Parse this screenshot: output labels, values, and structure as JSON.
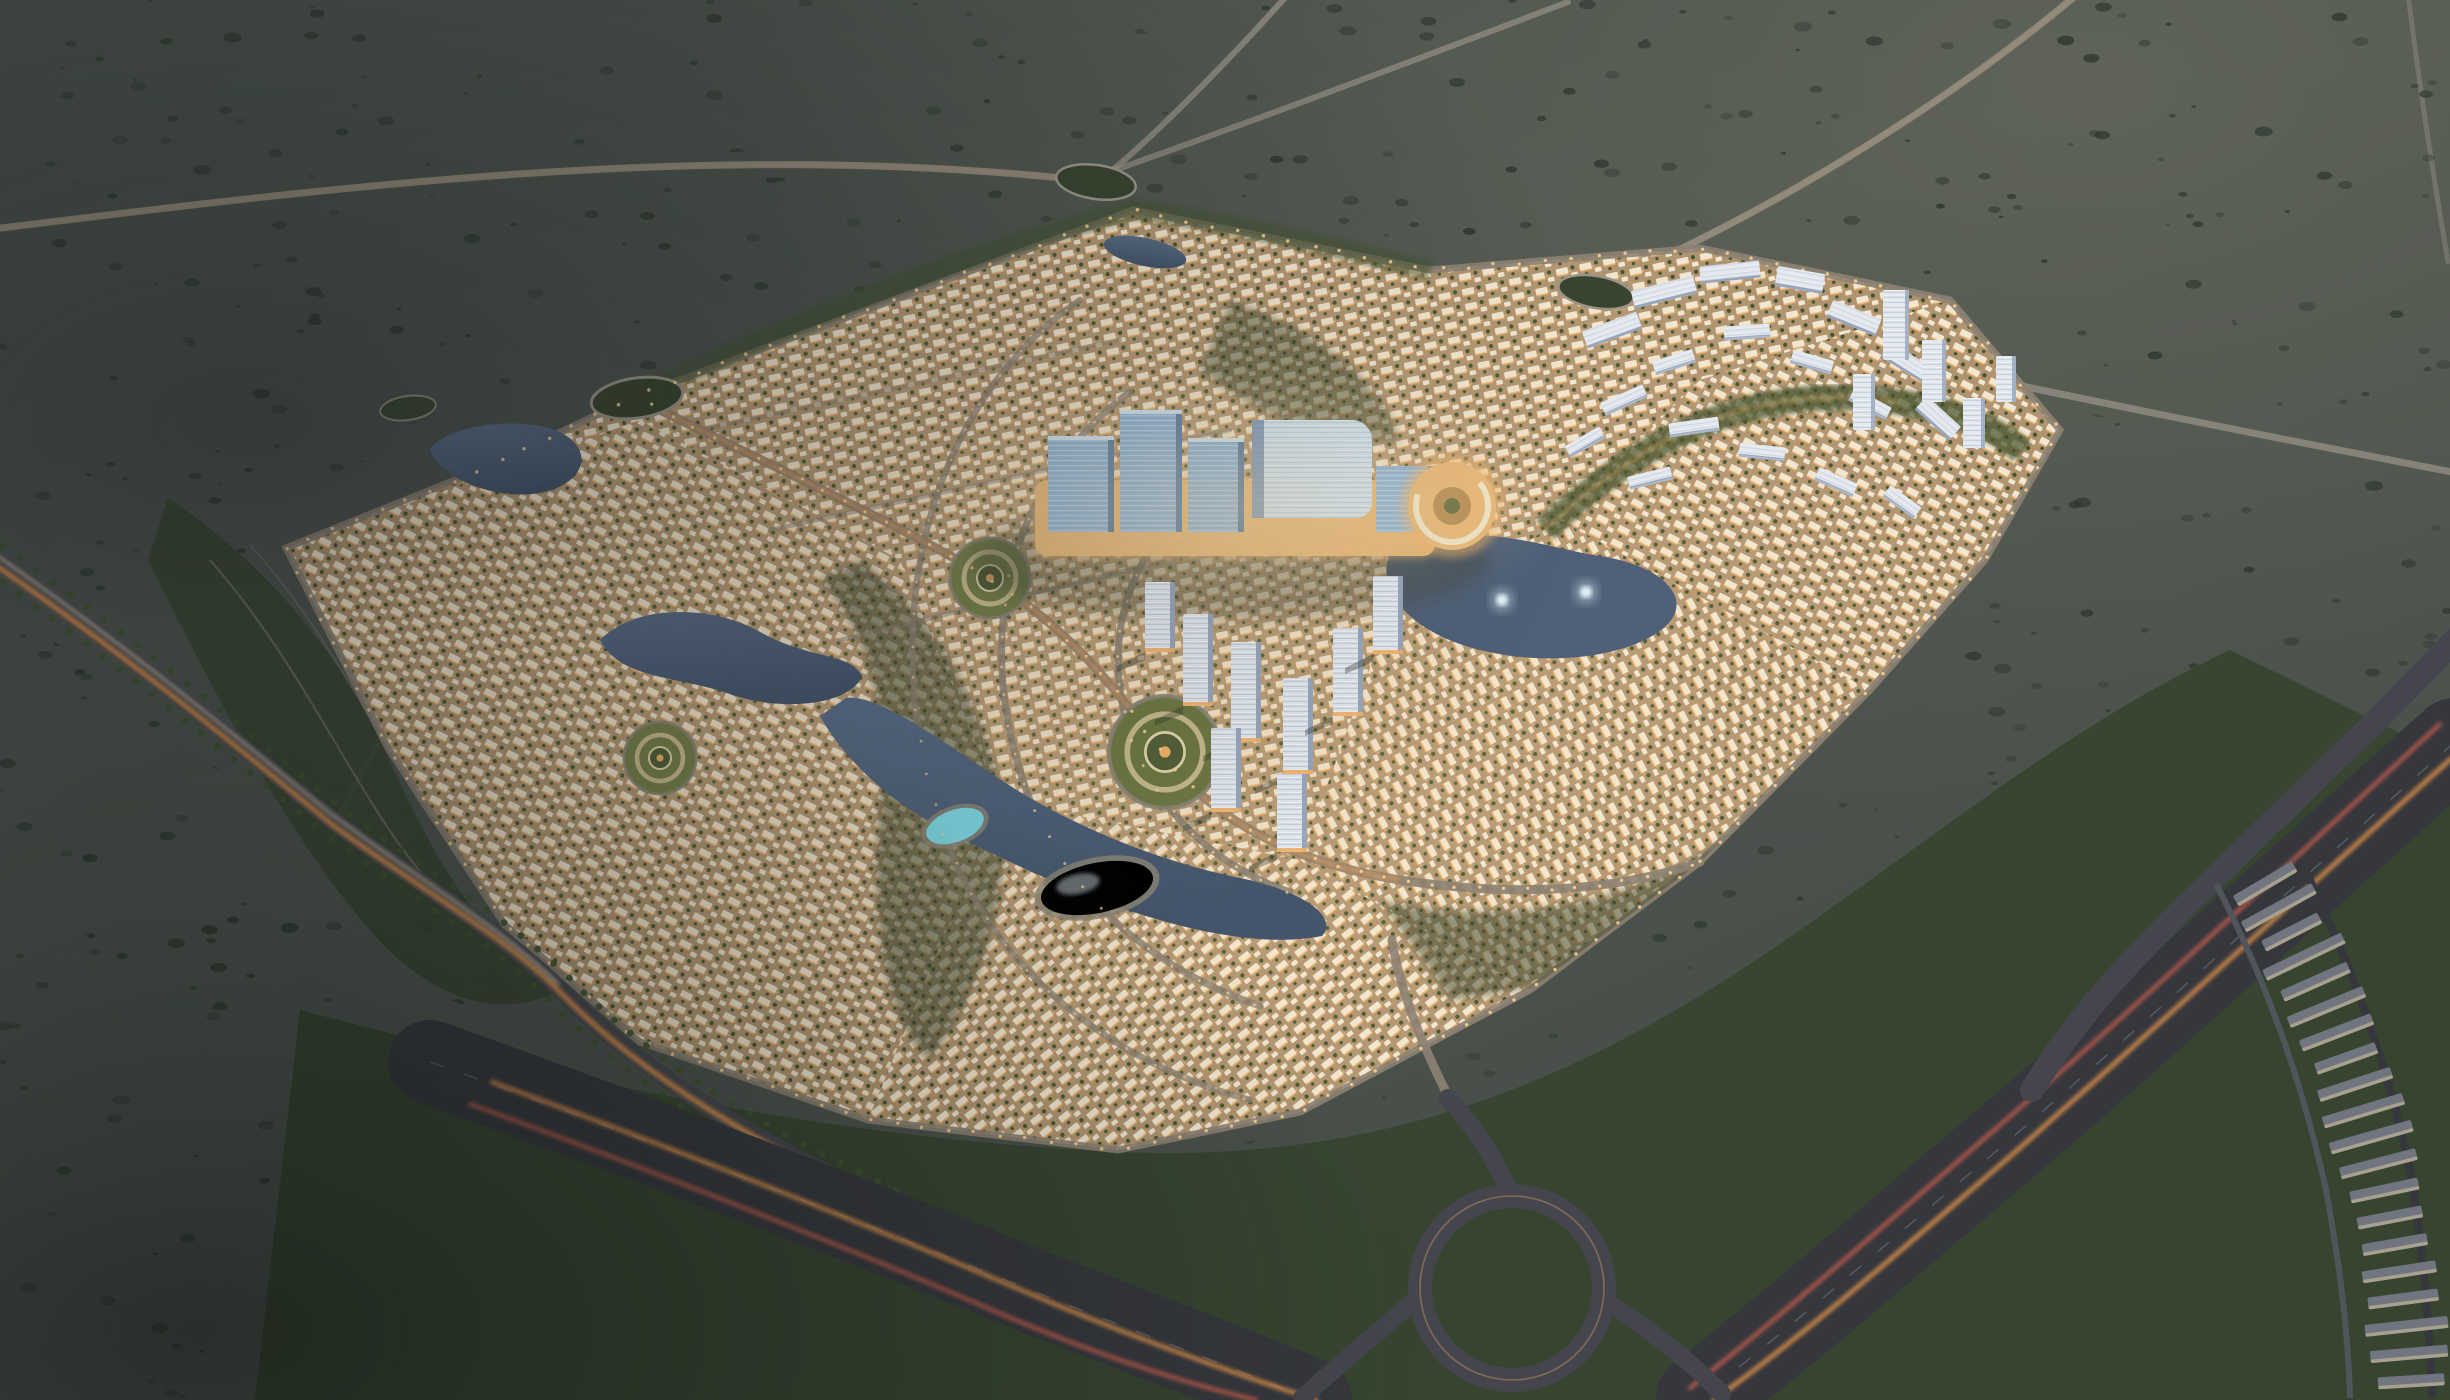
{
  "meta": {
    "title": "Aerial dusk view of a master-planned desert residential community rendering",
    "media_type": "photorealistic architectural aerial rendering",
    "time_of_day": "dusk",
    "visible_text": "none"
  },
  "scene": {
    "setting": "A dark scrub-dotted desert plain at twilight surrounding a fully illuminated diamond-shaped master-planned community, framed by highways with head/tail-light trails",
    "landmarks": [
      {
        "id": "commercial-district",
        "label": "Blue-glass hotel, office and mall cluster with warm-lit retail podium at the community center"
      },
      {
        "id": "round-building",
        "label": "Circular podium building glowing beside the central lake"
      },
      {
        "id": "central-lake",
        "label": "Central lake with two illuminated fountains"
      },
      {
        "id": "lagoon-pools",
        "label": "Two bright turquoise lagoon pools with sandy beach edges"
      },
      {
        "id": "garden-roundabouts",
        "label": "Three concentric landscaped garden roundabouts"
      },
      {
        "id": "villa-districts",
        "label": "Dense curved rows of warm-lit white villas and townhouses"
      },
      {
        "id": "apartment-cluster-east",
        "label": "Mid-rise apartment slabs and towers on the north-east edge"
      },
      {
        "id": "tower-cluster-south",
        "label": "High-rise residential towers in the south-east quarter"
      },
      {
        "id": "townhouse-band",
        "label": "Rows of unlit townhouses along the eastern highway"
      },
      {
        "id": "highway-east",
        "label": "Multi-lane highway sweeping along the east side"
      },
      {
        "id": "highway-south",
        "label": "Multi-lane highway corridor along the south-west side"
      },
      {
        "id": "interchange-loop",
        "label": "Looping interchange ramp at the south corner"
      },
      {
        "id": "west-boulevard",
        "label": "Palm-lined boulevard with orange light trails on the west side"
      },
      {
        "id": "desert-roads",
        "label": "Thin desert roads converging on oval roundabouts to the north"
      },
      {
        "id": "wadi-park",
        "label": "Scalloped wadi park band along the western boundary"
      }
    ]
  },
  "colors": {
    "desertDark": "#3f4641",
    "desertBase": "#4d544e",
    "desertLight": "#5d6156",
    "shrub": "#2f3830",
    "parkGreen": "#37442f",
    "treeGreen": "#42532f",
    "villaBase": "#b09470",
    "villaRoof": "#f1e7d2",
    "villaGlow": "#f3b368",
    "streetTan": "#8d8273",
    "roadLight": "#9b9589",
    "asphalt": "#45464d",
    "asphaltDark": "#35373d",
    "trailOrange": "#ffa24d",
    "trailRed": "#ff6d52",
    "trailWhite": "#ffeccb",
    "glowDot": "#ffd694",
    "waterDark": "#4f6078",
    "waterLight": "#6c82a0",
    "lagoon": "#7fd8e4",
    "fountain": "#e6f7fb",
    "glassBlue": "#8fb4d6",
    "glassLight": "#cfe2f0",
    "glassDark": "#5e7ea3",
    "podium": "#e9b877",
    "towerWhite": "#e3e7ee",
    "towerShade": "#9aa7bc",
    "thRow": "#70757f",
    "thLit": "#d9c59c",
    "sand": "#8d8878",
    "palm": "#3f5230"
  },
  "counts": {
    "fountains": 2,
    "lagoons": 2,
    "gardenRoundabouts": 3,
    "shrubs": 880,
    "palms": 54,
    "townhouseRows": 20
  }
}
